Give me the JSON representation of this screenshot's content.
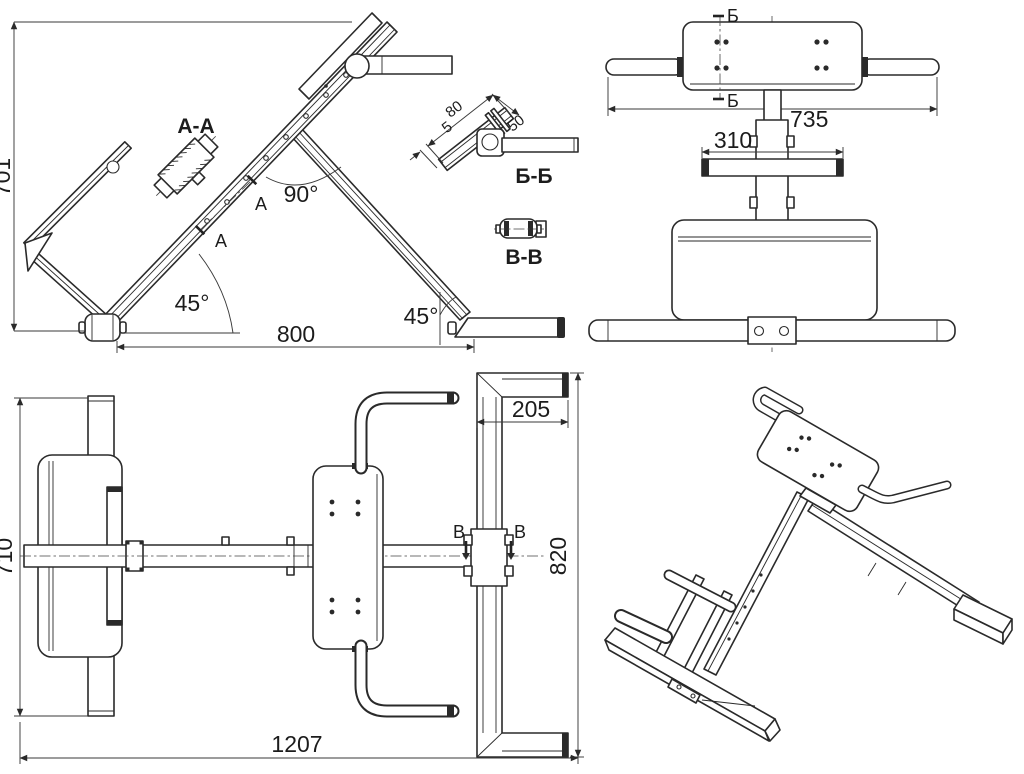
{
  "page": {
    "background": "#ffffff",
    "ink": "#2a2a2a"
  },
  "labels": {
    "side": {
      "height": "701",
      "length": "800",
      "front_angle": "45°",
      "rear_angle": "45°",
      "beam_angle": "90°",
      "section_title": "A-A",
      "cut_mark": "A"
    },
    "front": {
      "overall_width": "735",
      "footbar_width": "310",
      "cut_mark": "Б"
    },
    "section_bb": {
      "title": "Б-Б",
      "tube_len": "80",
      "bracket": "50",
      "gap": "5"
    },
    "section_vv": {
      "title": "В-В"
    },
    "plan": {
      "depth": "710",
      "overall_length": "1207",
      "rear_foot": "205",
      "rear_base": "820",
      "cut_mark": "В"
    }
  }
}
